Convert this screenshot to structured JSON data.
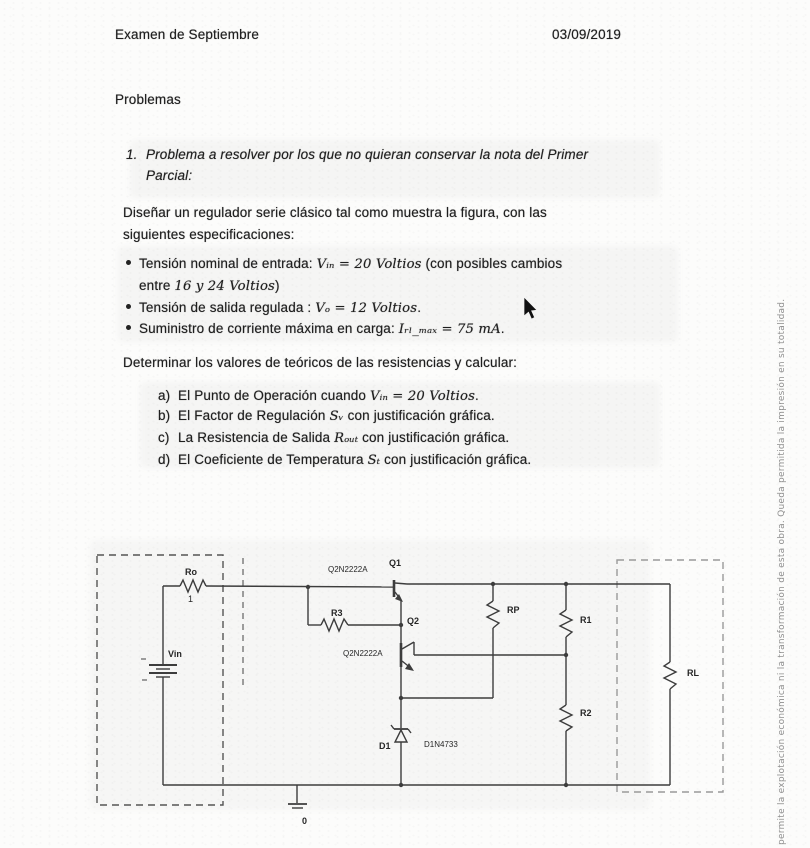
{
  "header": {
    "title": "Examen de Septiembre",
    "date": "03/09/2019"
  },
  "section": {
    "title": "Problemas"
  },
  "problem": {
    "number": "1.",
    "statement_line1": "Problema a resolver por los que no quieran conservar la nota del Primer",
    "statement_line2": "Parcial:",
    "design_line1": "Diseñar un regulador serie clásico tal como muestra la figura, con las",
    "design_line2": "siguientes especificaciones:",
    "bullets": [
      {
        "pre": "Tensión nominal de entrada: ",
        "math": "Vᵢₙ = 20 Voltios",
        "post": " (con posibles cambios",
        "cont_pre": "entre ",
        "cont_math": "16 y 24 Voltios",
        "cont_post": ")"
      },
      {
        "pre": "Tensión de salida regulada : ",
        "math": "Vₒ = 12 Voltios",
        "post": "."
      },
      {
        "pre": "Suministro de corriente máxima en carga: ",
        "math": "Iᵣₗ_ₘₐₓ = 75 mA",
        "post": "."
      }
    ],
    "determine": "Determinar los valores de teóricos de las resistencias y calcular:",
    "tasks": [
      {
        "label": "a)",
        "pre": "El Punto de Operación cuando ",
        "math": "Vᵢₙ = 20 Voltios",
        "post": "."
      },
      {
        "label": "b)",
        "pre": "El Factor de Regulación ",
        "math": "Sᵥ",
        "post": " con justificación gráfica."
      },
      {
        "label": "c)",
        "pre": "La Resistencia de Salida ",
        "math": "Rₒᵤₜ",
        "post": " con justificación gráfica."
      },
      {
        "label": "d)",
        "pre": "El Coeficiente de Temperatura ",
        "math": "Sₜ",
        "post": " con justificación gráfica."
      }
    ]
  },
  "circuit": {
    "labels": {
      "ro": "Ro",
      "ro_value": "1",
      "vin": "Vin",
      "q1": "Q1",
      "q1_model": "Q2N2222A",
      "q2": "Q2",
      "q2_model": "Q2N2222A",
      "r3": "R3",
      "rp": "RP",
      "r1": "R1",
      "r2": "R2",
      "rl": "RL",
      "d1": "D1",
      "d1_model": "D1N4733",
      "ground": "0"
    }
  },
  "watermark": "permite la explotación económica ni la transformación de esta obra. Queda permitida la impresión en su totalidad."
}
